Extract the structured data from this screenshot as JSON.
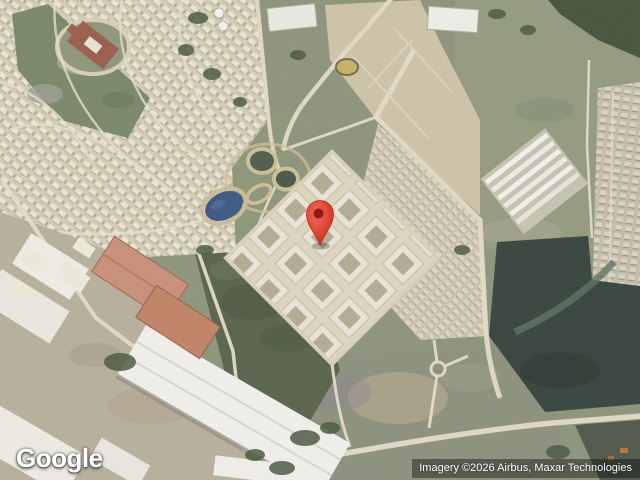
{
  "map": {
    "view_type": "satellite",
    "logo": "Google",
    "attribution": "Imagery ©2026 Airbus, Maxar Technologies",
    "marker": {
      "transform": "translate(320,245)",
      "color": "#e8473b",
      "inner_color": "#7e150d"
    },
    "colors": {
      "pin": "#e8473b",
      "pin_inner": "#7e150d",
      "attribution_bg": "rgba(0,0,0,0.38)",
      "attribution_text": "#ffffff",
      "logo_text": "#ffffff"
    }
  }
}
